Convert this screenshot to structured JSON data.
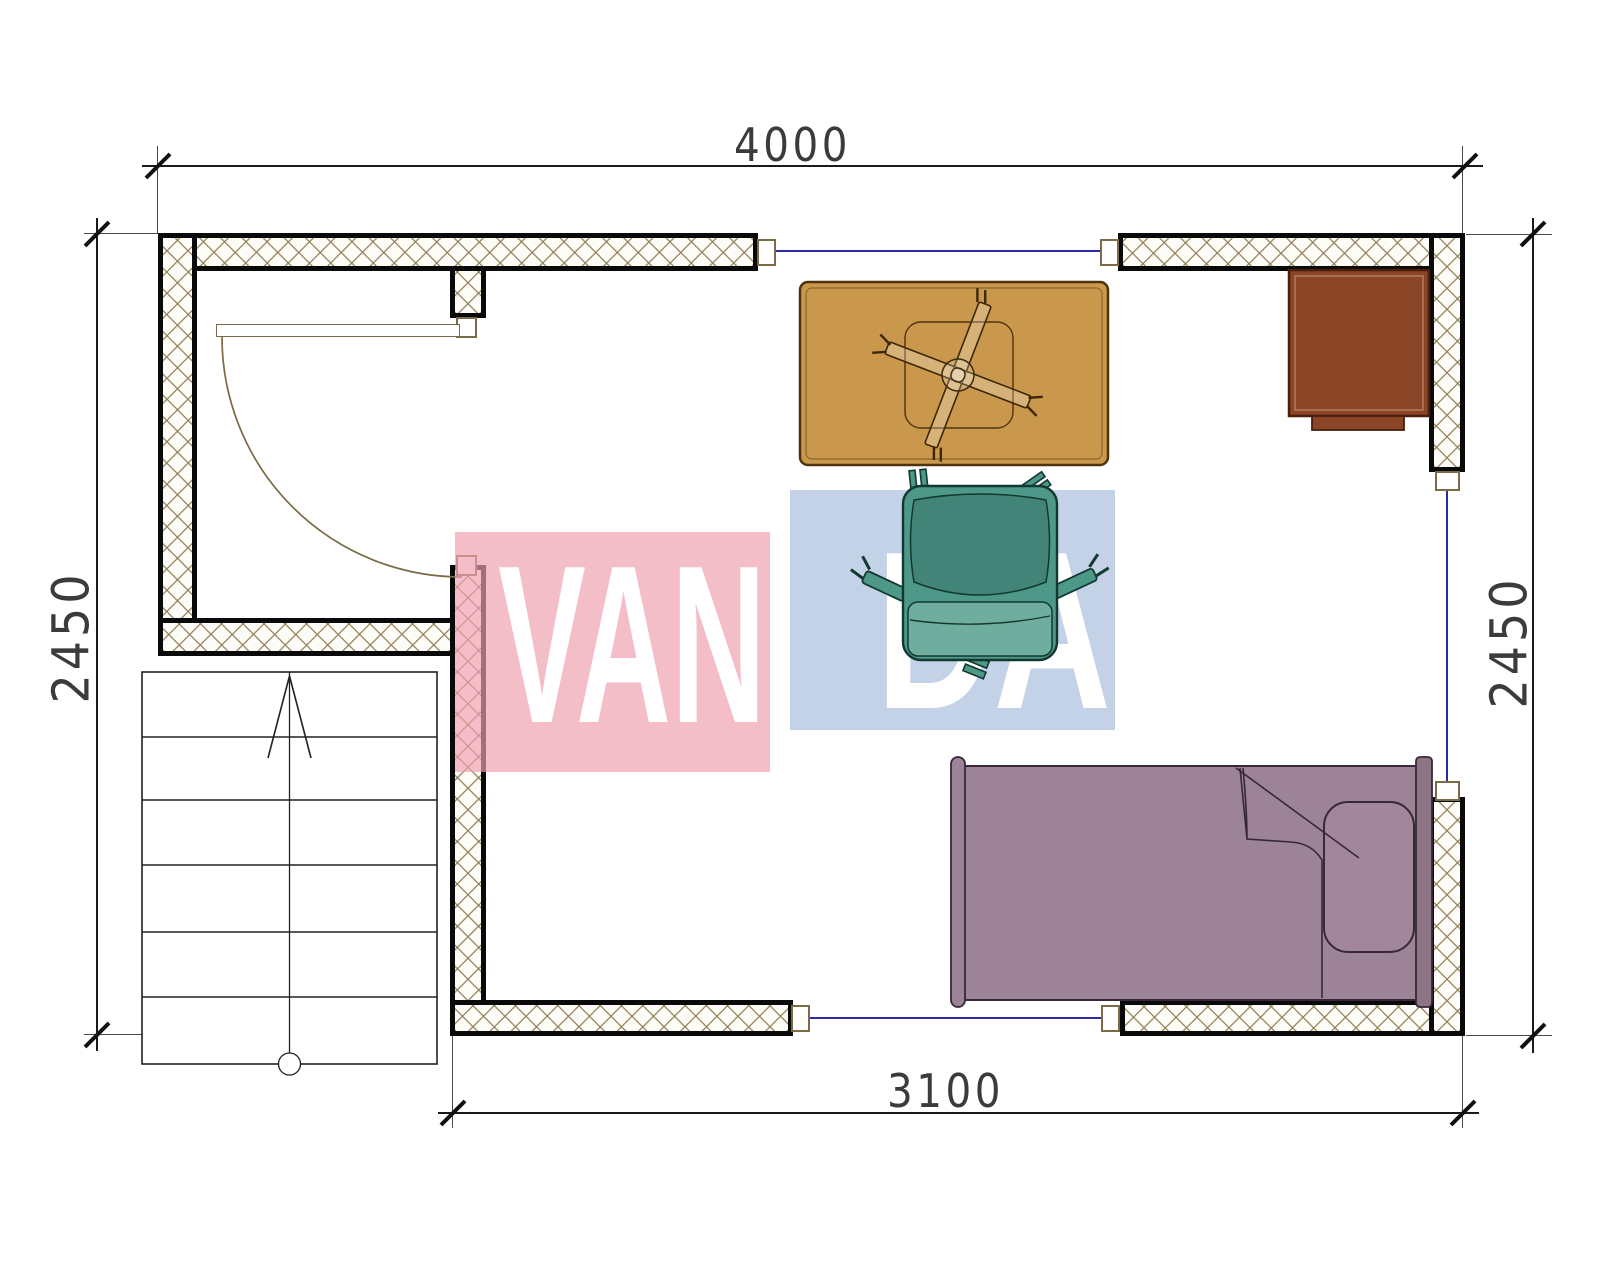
{
  "title": "apartment-floor-plan",
  "dimensions": {
    "top": "4000",
    "bottom": "3100",
    "left": "2450",
    "right": "2450"
  },
  "watermark": {
    "text": "VANDA",
    "left_part": "VAN",
    "right_part": "DA"
  },
  "objects": {
    "stairs": "staircase-up-arrow",
    "door": "swing-door",
    "table": "table-with-cross-base",
    "chair": "armchair",
    "nightstand": "nightstand",
    "bed": "single-bed-with-pillow",
    "windows": [
      "top-window",
      "right-window",
      "bottom-window"
    ]
  },
  "colors": {
    "dim-line": "#1a1a1a",
    "dim-text": "#3b3b3b",
    "window-glass": "#2b2ba8",
    "door-trim": "#7a6a45",
    "wall-hatch": "#8f7d55",
    "table": "#c9984d",
    "table-border": "#50330d",
    "nightstand": "#8a4527",
    "chair": "#4e988a",
    "chair-dark": "#428578",
    "chair-light": "#6fae9e",
    "bed": "#9c8395",
    "bed-line": "#362839",
    "watermark-pink": "#ef9fb0",
    "watermark-blue": "#9fb6d9"
  }
}
